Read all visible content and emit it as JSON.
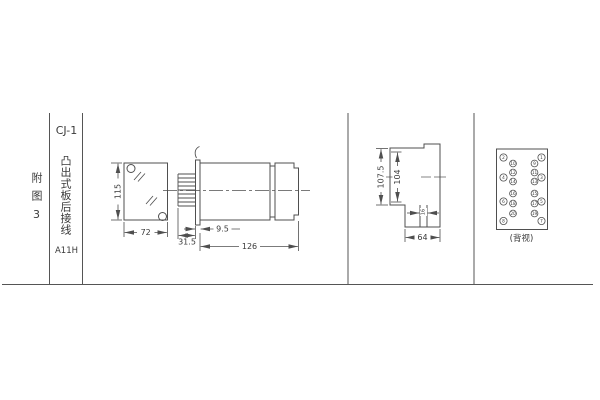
{
  "left_panel": {
    "figure_label": "附图3",
    "model": "CJ-1",
    "mount_type": "凸出式板后接线",
    "code": "A11H"
  },
  "front_view": {
    "height_mm": "115",
    "width_mm": "72"
  },
  "side_view": {
    "panel_thickness_mm": "9.5",
    "front_depth_mm": "31.5",
    "body_length_mm": "126"
  },
  "rear_mount_view": {
    "overall_height_mm": "107.5",
    "cutout_height_mm": "104",
    "tab_width_mm": "16",
    "width_mm": "64"
  },
  "back_view": {
    "caption": "(背视)",
    "pins": {
      "outer_left": [
        "2",
        "4",
        "6",
        "8"
      ],
      "inner_left": [
        "10",
        "12",
        "14",
        "16",
        "18",
        "20"
      ],
      "inner_right": [
        "9",
        "11",
        "13",
        "15",
        "17",
        "19"
      ],
      "outer_right": [
        "1",
        "3",
        "5",
        "7"
      ]
    }
  }
}
